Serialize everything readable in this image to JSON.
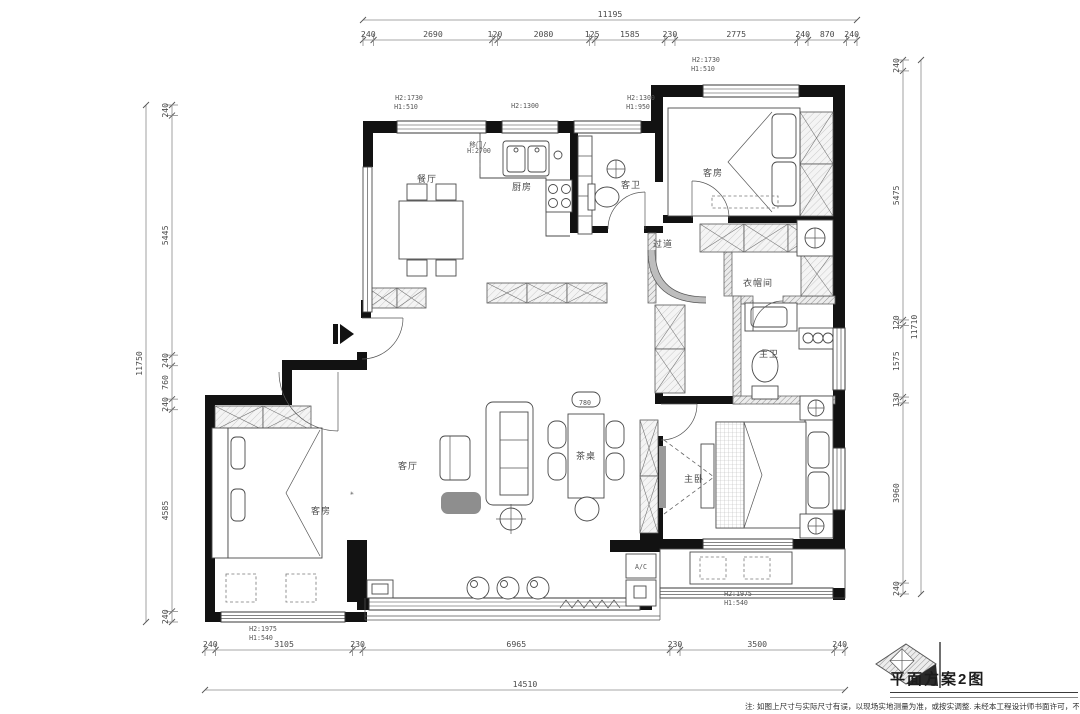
{
  "title_block": {
    "title": "平面方案2图"
  },
  "footnote": "注: 如图上尺寸与实际尺寸有误，以现场实地测量为准，或按实调整. 未经本工程设计师书面许可，不得将任何部分分",
  "dimension_chains": [
    {
      "name": "dim-top",
      "dir": "h",
      "line": 40,
      "lo": 363,
      "hi": 857,
      "total": "11195",
      "total_line": 20,
      "values": [
        240,
        2690,
        120,
        2080,
        125,
        1585,
        230,
        2775,
        240,
        870,
        240
      ]
    },
    {
      "name": "dim-bottom",
      "dir": "h",
      "line": 650,
      "lo": 205,
      "hi": 845,
      "total": "14510",
      "total_line": 690,
      "values": [
        240,
        3105,
        230,
        6965,
        230,
        3500,
        240
      ]
    },
    {
      "name": "dim-left",
      "dir": "v",
      "line": 172,
      "lo": 105,
      "hi": 622,
      "total": "11750",
      "total_line": 146,
      "values": [
        240,
        5445,
        240,
        760,
        240,
        4585,
        240
      ]
    },
    {
      "name": "dim-right",
      "dir": "v",
      "line": 903,
      "lo": 60,
      "hi": 594,
      "total": "11710",
      "total_line": 921,
      "values": [
        240,
        5475,
        120,
        1575,
        130,
        3960,
        240
      ]
    }
  ],
  "room_labels": [
    {
      "n": "room-label-dining",
      "t": "餐厅",
      "x": 427,
      "y": 182
    },
    {
      "n": "room-label-kitchen",
      "t": "厨房",
      "x": 522,
      "y": 190
    },
    {
      "n": "room-label-guest-bath",
      "t": "客卫",
      "x": 631,
      "y": 188
    },
    {
      "n": "room-label-guest-room-1",
      "t": "客房",
      "x": 713,
      "y": 176
    },
    {
      "n": "room-label-hallway",
      "t": "过道",
      "x": 663,
      "y": 247
    },
    {
      "n": "room-label-closet",
      "t": "衣帽间",
      "x": 758,
      "y": 286
    },
    {
      "n": "room-label-master-bath",
      "t": "主卫",
      "x": 769,
      "y": 357
    },
    {
      "n": "room-label-master-bed",
      "t": "主卧",
      "x": 694,
      "y": 482
    },
    {
      "n": "room-label-living",
      "t": "客厅",
      "x": 408,
      "y": 469
    },
    {
      "n": "room-label-guest-room-2",
      "t": "客房",
      "x": 321,
      "y": 514
    },
    {
      "n": "room-label-tea-table",
      "t": "茶桌",
      "x": 586,
      "y": 459
    }
  ],
  "height_labels": [
    {
      "n": "win-h-label",
      "t": "H2:1730",
      "x": 409,
      "y": 100
    },
    {
      "n": "win-h-label",
      "t": "H1:510",
      "x": 406,
      "y": 109
    },
    {
      "n": "win-h-label",
      "t": "H2:1300",
      "x": 525,
      "y": 108
    },
    {
      "n": "win-h-label",
      "t": "H2:1300",
      "x": 641,
      "y": 100
    },
    {
      "n": "win-h-label",
      "t": "H1:950",
      "x": 638,
      "y": 109
    },
    {
      "n": "win-h-label",
      "t": "H2:1730",
      "x": 706,
      "y": 62
    },
    {
      "n": "win-h-label",
      "t": "H1:510",
      "x": 703,
      "y": 71
    },
    {
      "n": "win-h-label",
      "t": "H2:1975",
      "x": 738,
      "y": 596
    },
    {
      "n": "win-h-label",
      "t": "H1:540",
      "x": 736,
      "y": 605
    },
    {
      "n": "win-h-label",
      "t": "H2:1975",
      "x": 263,
      "y": 631
    },
    {
      "n": "win-h-label",
      "t": "H1:540",
      "x": 261,
      "y": 640
    }
  ],
  "misc_labels": [
    {
      "n": "tea-table-dim",
      "t": "780",
      "x": 585,
      "y": 405,
      "s": 6
    },
    {
      "n": "ac-unit-label",
      "t": "A/C",
      "x": 641,
      "y": 569,
      "s": 6.5
    },
    {
      "n": "door-note-1",
      "t": "移门/",
      "x": 478,
      "y": 147,
      "s": 5
    },
    {
      "n": "door-note-2",
      "t": "H:2700",
      "x": 479,
      "y": 153,
      "s": 5
    },
    {
      "n": "plant-icon",
      "t": "✳",
      "x": 352,
      "y": 495,
      "s": 13
    }
  ]
}
